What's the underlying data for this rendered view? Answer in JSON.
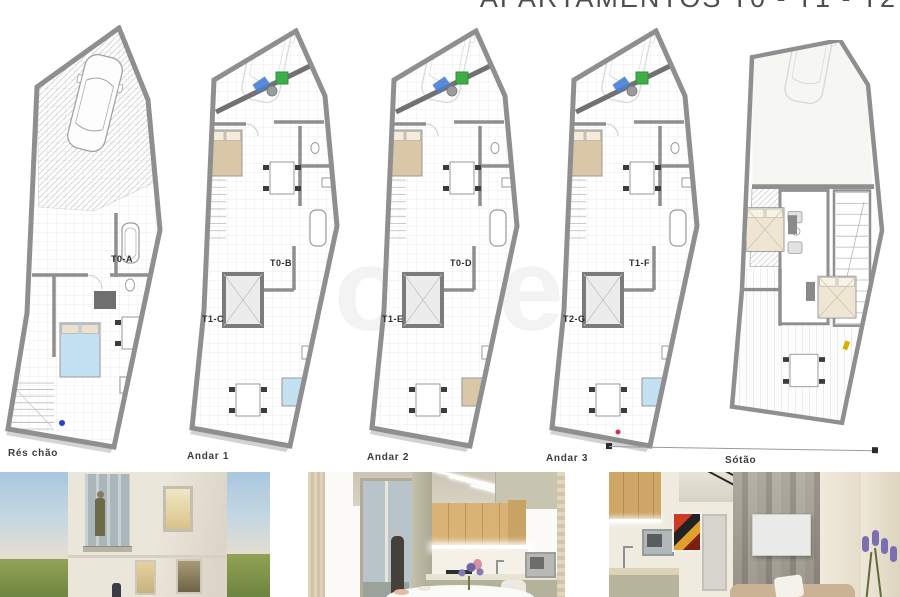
{
  "title": "APARTAMENTOS T0 - T1 - T2",
  "watermark": "zone",
  "plans": [
    {
      "floor_label": "Rés chão",
      "units": [
        {
          "label": "T0-A"
        }
      ]
    },
    {
      "floor_label": "Andar 1",
      "units": [
        {
          "label": "T0-B"
        },
        {
          "label": "T1-C"
        }
      ]
    },
    {
      "floor_label": "Andar 2",
      "units": [
        {
          "label": "T0-D"
        },
        {
          "label": "T1-E"
        }
      ]
    },
    {
      "floor_label": "Andar 3",
      "units": [
        {
          "label": "T1-F"
        },
        {
          "label": "T2-G"
        }
      ]
    },
    {
      "floor_label": "Sótão",
      "units": []
    }
  ],
  "colors": {
    "wall": "#8f8f8f",
    "wall_dark": "#717171",
    "grid": "#e6e6e6",
    "hatch": "#d0d0d0",
    "accent_green": "#3fae49",
    "accent_blue": "#4a7fd4",
    "bed_tan": "#d9c7a8",
    "bed_blue": "#c3e1f3",
    "bed_attic": "#eee6d2",
    "entry_dot_blue": "#2244cc",
    "entry_dot_red": "#cf3344",
    "accent_yellow": "#d4b400"
  },
  "photos": [
    {
      "name": "facade-render"
    },
    {
      "name": "kitchen-render"
    },
    {
      "name": "living-room-render"
    }
  ]
}
